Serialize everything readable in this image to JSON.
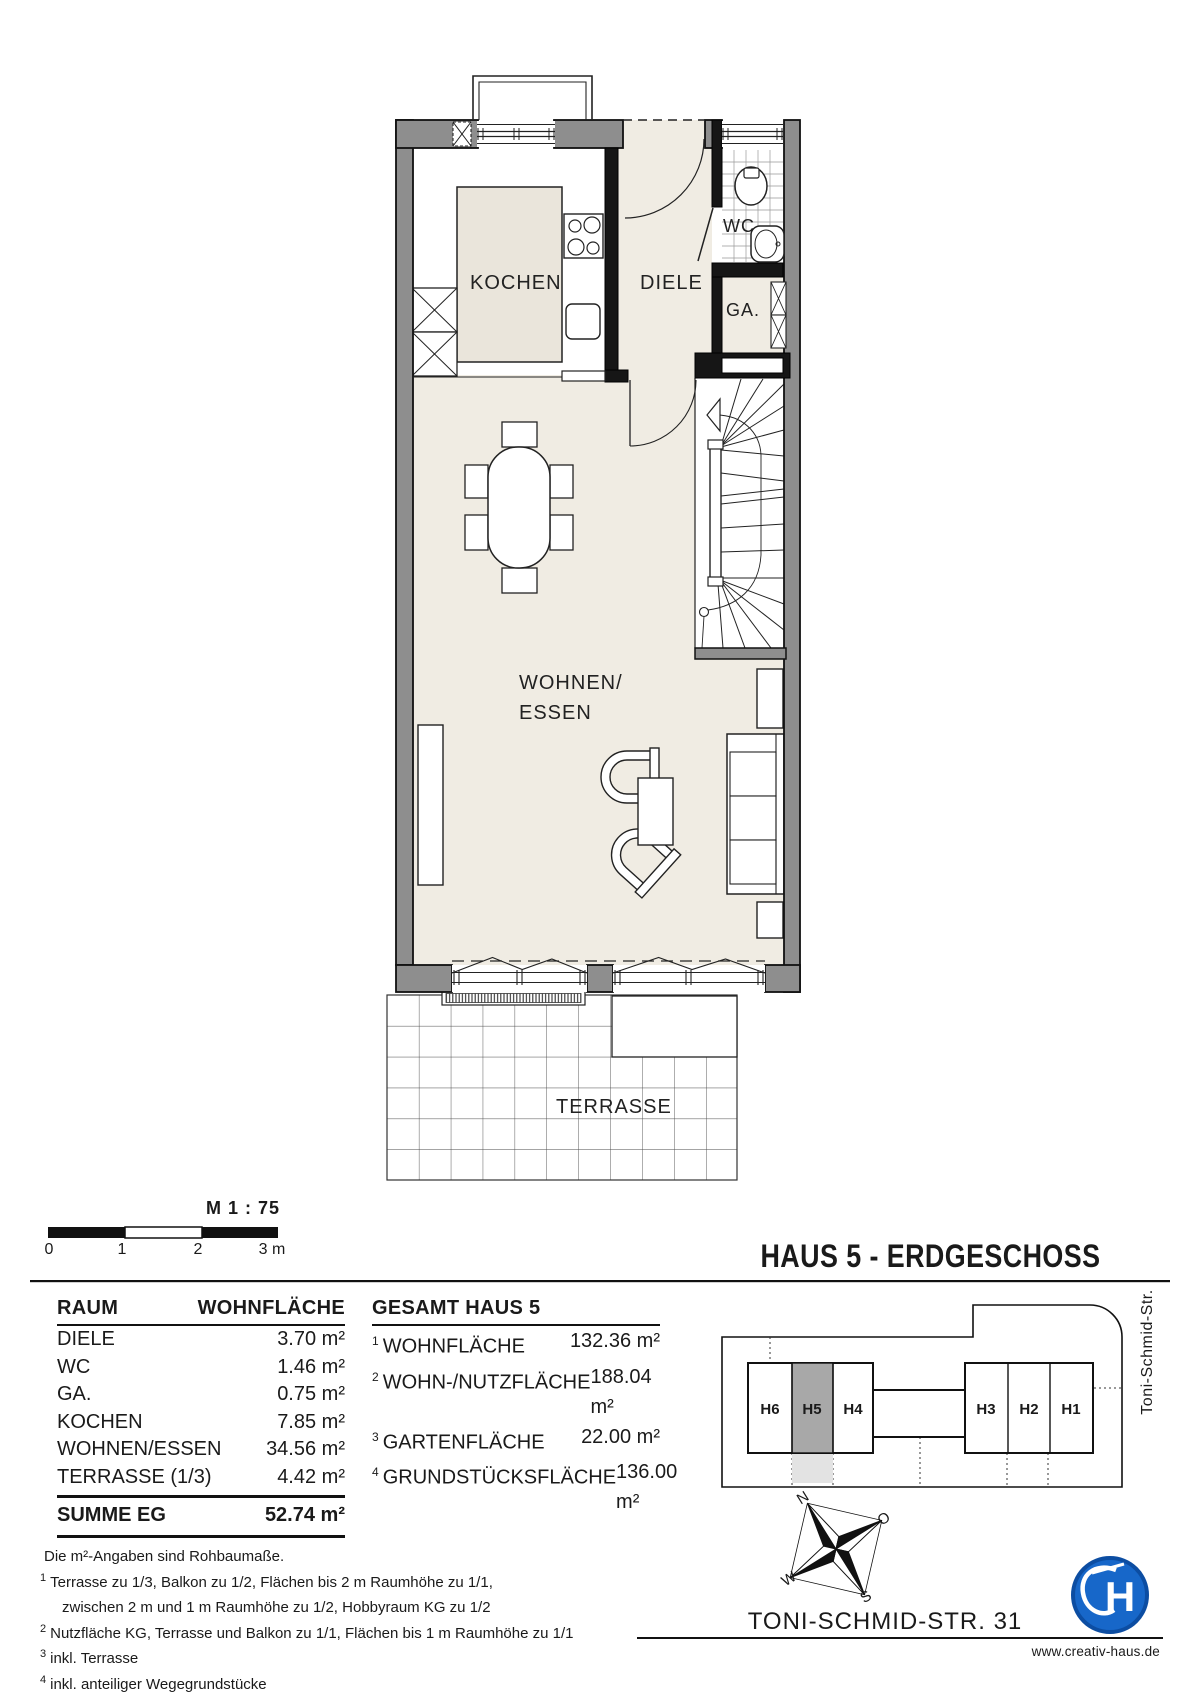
{
  "sheet": {
    "scale": {
      "label": "M 1 : 75",
      "ticks": [
        "0",
        "1",
        "2",
        "3 m"
      ]
    },
    "title": "HAUS 5 - ERDGESCHOSS",
    "address": "TONI-SCHMID-STR. 31",
    "website": "www.creativ-haus.de",
    "logo_monogram": "H"
  },
  "plan": {
    "labels": {
      "kochen": "KOCHEN",
      "diele": "DIELE",
      "wc": "WC",
      "ga": "GA.",
      "wohnen_line1": "WOHNEN/",
      "wohnen_line2": "ESSEN",
      "terrasse": "TERRASSE"
    }
  },
  "room_table": {
    "col_room": "RAUM",
    "col_area": "WOHNFLÄCHE",
    "rows": [
      {
        "name": "DIELE",
        "area": "3.70 m²"
      },
      {
        "name": "WC",
        "area": "1.46 m²"
      },
      {
        "name": "GA.",
        "area": "0.75 m²"
      },
      {
        "name": "KOCHEN",
        "area": "7.85 m²"
      },
      {
        "name": "WOHNEN/ESSEN",
        "area": "34.56 m²"
      },
      {
        "name": "TERRASSE (1/3)",
        "area": "4.42 m²"
      }
    ],
    "sum_label": "SUMME EG",
    "sum_value": "52.74 m²"
  },
  "totals_table": {
    "title": "GESAMT HAUS 5",
    "rows": [
      {
        "sup": "1",
        "label": "WOHNFLÄCHE",
        "value": "132.36 m²"
      },
      {
        "sup": "2",
        "label": "WOHN-/NUTZFLÄCHE",
        "value": "188.04 m²"
      },
      {
        "sup": "3",
        "label": "GARTENFLÄCHE",
        "value": "22.00 m²"
      },
      {
        "sup": "4",
        "label": "GRUNDSTÜCKSFLÄCHE",
        "value": "136.00 m²"
      }
    ]
  },
  "notes": {
    "lines": [
      {
        "sup": "",
        "text": "Die m²-Angaben sind Rohbaumaße."
      },
      {
        "sup": "1",
        "text": "Terrasse  zu 1/3, Balkon zu 1/2, Flächen bis 2 m Raumhöhe zu 1/1,"
      },
      {
        "sup": "",
        "text": "zwischen 2 m und 1 m Raumhöhe zu 1/2, Hobbyraum KG zu 1/2"
      },
      {
        "sup": "2",
        "text": "Nutzfläche KG, Terrasse und Balkon zu 1/1, Flächen bis 1 m Raumhöhe zu 1/1"
      },
      {
        "sup": "3",
        "text": "inkl. Terrasse"
      },
      {
        "sup": "4",
        "text": "inkl. anteiliger Wegegrundstücke"
      }
    ]
  },
  "site_plan": {
    "street": "Toni-Schmid-Str.",
    "houses": [
      {
        "id": "H6"
      },
      {
        "id": "H5"
      },
      {
        "id": "H4"
      },
      {
        "id": "H3"
      },
      {
        "id": "H2"
      },
      {
        "id": "H1"
      }
    ],
    "highlight": "H5",
    "compass": {
      "n": "N",
      "o": "O",
      "w": "W",
      "s": "S"
    }
  },
  "colors": {
    "wall_gray": "#8e8e8e",
    "wall_black": "#161616",
    "floor_beige": "#f0ece3",
    "counter_beige": "#eae5db",
    "highlight_gray": "#a8a8a8",
    "garden_gray": "#e3e3e3",
    "logo_blue": "#1767c9"
  }
}
